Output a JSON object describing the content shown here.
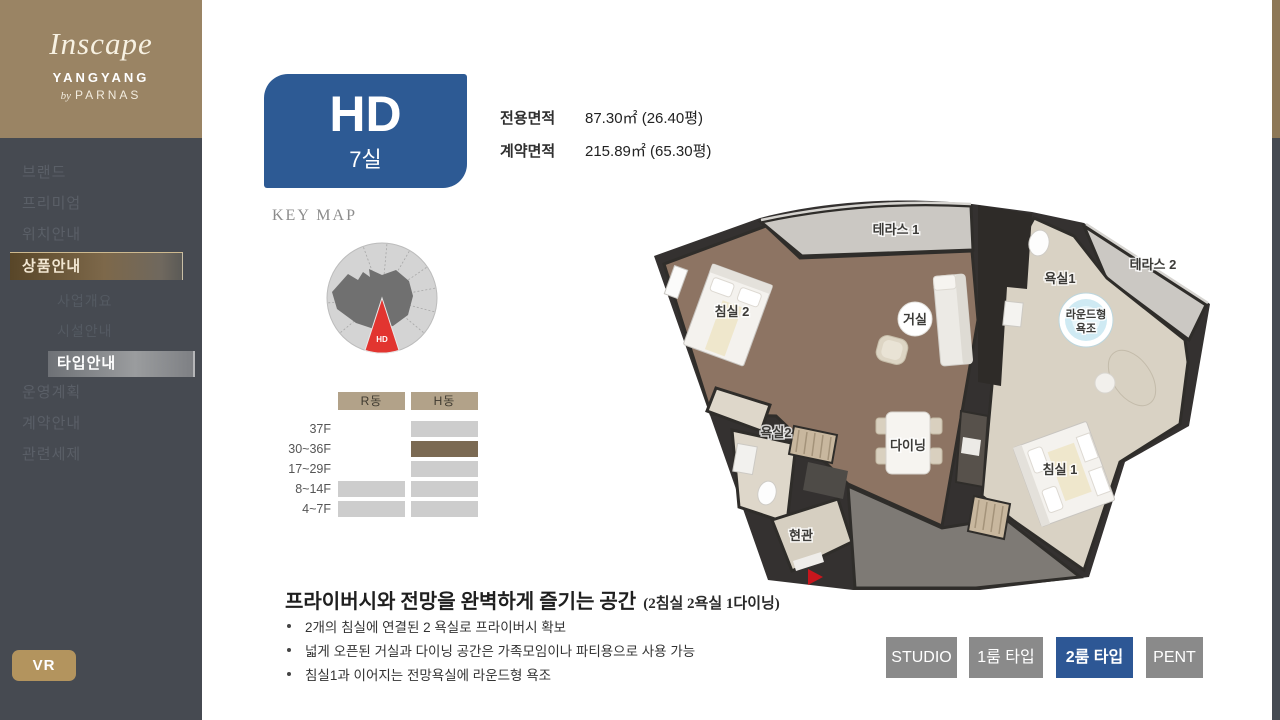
{
  "logo": {
    "script": "Inscape",
    "region": "YANGYANG",
    "by": "by",
    "brand": "PARNAS"
  },
  "sidebar": {
    "items": [
      {
        "label": "브랜드",
        "active": false
      },
      {
        "label": "프리미엄",
        "active": false
      },
      {
        "label": "위치안내",
        "active": false
      },
      {
        "label": "상품안내",
        "active": true
      },
      {
        "label": "운영계획",
        "active": false
      },
      {
        "label": "계약안내",
        "active": false
      },
      {
        "label": "관련세제",
        "active": false
      }
    ],
    "subitems": [
      {
        "label": "사업개요",
        "active": false
      },
      {
        "label": "시설안내",
        "active": false
      },
      {
        "label": "타입안내",
        "active": true
      }
    ],
    "vr": "VR"
  },
  "unit": {
    "code": "HD",
    "rooms": "7실"
  },
  "area": {
    "label1": "전용면적",
    "value1": "87.30㎡ (26.40평)",
    "label2": "계약면적",
    "value2": "215.89㎡ (65.30평)"
  },
  "keymap": {
    "title": "KEY MAP",
    "marker": "HD"
  },
  "floors": {
    "columns": [
      {
        "label": "R동"
      },
      {
        "label": "H동"
      }
    ],
    "rows": [
      {
        "label": "37F",
        "r": "empty",
        "h": "gray"
      },
      {
        "label": "30~36F",
        "r": "empty",
        "h": "highlight"
      },
      {
        "label": "17~29F",
        "r": "empty",
        "h": "gray"
      },
      {
        "label": "8~14F",
        "r": "gray",
        "h": "gray"
      },
      {
        "label": "4~7F",
        "r": "gray",
        "h": "gray"
      }
    ]
  },
  "plan": {
    "terrace1": "테라스 1",
    "terrace2": "테라스 2",
    "bath1": "욕실1",
    "tub1": "라운드형",
    "tub2": "욕조",
    "living": "거실",
    "bedroom2": "침실 2",
    "bath2": "욕실2",
    "dining": "다이닝",
    "bedroom1": "침실 1",
    "entrance": "현관"
  },
  "description": {
    "title": "프라이버시와 전망을 완벽하게 즐기는 공간",
    "subtitle": "(2침실 2욕실 1다이닝)",
    "bullets": [
      {
        "text": "2개의 침실에 연결된 2 욕실로 프라이버시 확보"
      },
      {
        "text": "넓게 오픈된 거실과 다이닝 공간은 가족모임이나 파티용으로 사용 가능"
      },
      {
        "text": "침실1과 이어지는 전망욕실에 라운드형 욕조"
      }
    ]
  },
  "tabs": [
    {
      "label": "STUDIO",
      "active": false
    },
    {
      "label": "1룸 타입",
      "active": false
    },
    {
      "label": "2룸 타입",
      "active": true
    },
    {
      "label": "PENT",
      "active": false
    }
  ],
  "colors": {
    "accent_blue": "#2d5795",
    "badge_blue": "#2d5a94",
    "gold": "#b3945e",
    "logo_brown": "#9a8464",
    "sidebar_dark": "#464a51",
    "highlight_brown": "#7b6a53",
    "header_tan": "#b2a289",
    "keymap_red": "#e23530"
  }
}
